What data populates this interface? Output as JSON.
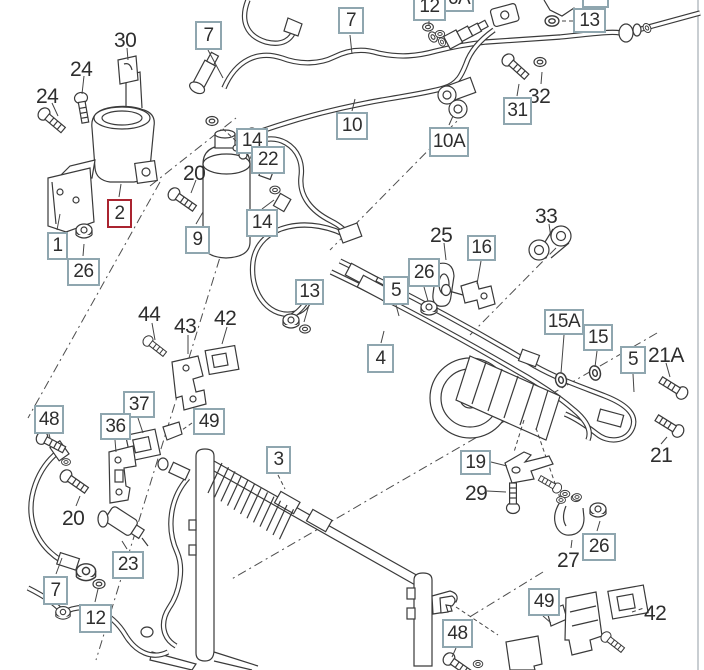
{
  "diagram": {
    "type": "exploded-parts-diagram",
    "subject": "air-conditioning-system",
    "highlighted_part": "2"
  },
  "colors": {
    "box_border": "#8fa6af",
    "highlight_border": "#aa2430",
    "line_art": "#3a3a3a",
    "text": "#2e2e2e",
    "background": "#ffffff"
  },
  "labels": {
    "boxed": [
      {
        "text": "7",
        "x": 195,
        "y": 21,
        "w": 27,
        "h": 29
      },
      {
        "text": "7",
        "x": 338,
        "y": 7,
        "w": 26,
        "h": 27
      },
      {
        "text": "12",
        "x": 413,
        "y": -7,
        "w": 33,
        "h": 28
      },
      {
        "text": "6A",
        "x": 444,
        "y": -15,
        "w": 30,
        "h": 27
      },
      {
        "text": "8",
        "x": 582,
        "y": -19,
        "w": 27,
        "h": 27
      },
      {
        "text": "13",
        "x": 573,
        "y": 8,
        "w": 33,
        "h": 25
      },
      {
        "text": "31",
        "x": 503,
        "y": 97,
        "w": 29,
        "h": 28
      },
      {
        "text": "10",
        "x": 336,
        "y": 112,
        "w": 32,
        "h": 28
      },
      {
        "text": "10A",
        "x": 429,
        "y": 127,
        "w": 40,
        "h": 30
      },
      {
        "text": "14",
        "x": 236,
        "y": 128,
        "w": 32,
        "h": 26
      },
      {
        "text": "22",
        "x": 251,
        "y": 146,
        "w": 34,
        "h": 28
      },
      {
        "text": "14",
        "x": 246,
        "y": 209,
        "w": 32,
        "h": 28
      },
      {
        "text": "9",
        "x": 185,
        "y": 226,
        "w": 25,
        "h": 28
      },
      {
        "text": "1",
        "x": 47,
        "y": 232,
        "w": 21,
        "h": 28
      },
      {
        "text": "26",
        "x": 67,
        "y": 258,
        "w": 33,
        "h": 28
      },
      {
        "text": "13",
        "x": 295,
        "y": 279,
        "w": 29,
        "h": 26
      },
      {
        "text": "5",
        "x": 383,
        "y": 276,
        "w": 26,
        "h": 29
      },
      {
        "text": "4",
        "x": 367,
        "y": 344,
        "w": 27,
        "h": 29
      },
      {
        "text": "26",
        "x": 408,
        "y": 258,
        "w": 32,
        "h": 29
      },
      {
        "text": "16",
        "x": 467,
        "y": 235,
        "w": 29,
        "h": 26
      },
      {
        "text": "15A",
        "x": 544,
        "y": 309,
        "w": 40,
        "h": 26
      },
      {
        "text": "15",
        "x": 583,
        "y": 324,
        "w": 30,
        "h": 27
      },
      {
        "text": "5",
        "x": 620,
        "y": 346,
        "w": 26,
        "h": 28
      },
      {
        "text": "19",
        "x": 460,
        "y": 450,
        "w": 31,
        "h": 25
      },
      {
        "text": "3",
        "x": 266,
        "y": 446,
        "w": 25,
        "h": 28
      },
      {
        "text": "48",
        "x": 34,
        "y": 405,
        "w": 30,
        "h": 29
      },
      {
        "text": "37",
        "x": 123,
        "y": 391,
        "w": 32,
        "h": 27
      },
      {
        "text": "36",
        "x": 100,
        "y": 413,
        "w": 31,
        "h": 27
      },
      {
        "text": "49",
        "x": 193,
        "y": 408,
        "w": 32,
        "h": 27
      },
      {
        "text": "23",
        "x": 112,
        "y": 551,
        "w": 32,
        "h": 28
      },
      {
        "text": "7",
        "x": 43,
        "y": 576,
        "w": 25,
        "h": 29
      },
      {
        "text": "12",
        "x": 79,
        "y": 604,
        "w": 33,
        "h": 29
      },
      {
        "text": "26",
        "x": 582,
        "y": 533,
        "w": 34,
        "h": 28
      },
      {
        "text": "49",
        "x": 528,
        "y": 588,
        "w": 32,
        "h": 28
      },
      {
        "text": "48",
        "x": 442,
        "y": 619,
        "w": 31,
        "h": 29
      }
    ],
    "highlighted": [
      {
        "text": "2",
        "x": 107,
        "y": 199,
        "w": 25,
        "h": 29
      }
    ],
    "plain": [
      {
        "text": "30",
        "x": 114,
        "y": 29
      },
      {
        "text": "24",
        "x": 70,
        "y": 58
      },
      {
        "text": "24",
        "x": 36,
        "y": 85
      },
      {
        "text": "20",
        "x": 183,
        "y": 162
      },
      {
        "text": "32",
        "x": 528,
        "y": 85
      },
      {
        "text": "25",
        "x": 430,
        "y": 224
      },
      {
        "text": "33",
        "x": 535,
        "y": 205
      },
      {
        "text": "21A",
        "x": 648,
        "y": 344
      },
      {
        "text": "21",
        "x": 650,
        "y": 444
      },
      {
        "text": "29",
        "x": 465,
        "y": 482
      },
      {
        "text": "27",
        "x": 557,
        "y": 549
      },
      {
        "text": "44",
        "x": 138,
        "y": 303
      },
      {
        "text": "43",
        "x": 174,
        "y": 315
      },
      {
        "text": "42",
        "x": 214,
        "y": 307
      },
      {
        "text": "20",
        "x": 62,
        "y": 507
      },
      {
        "text": "42",
        "x": 644,
        "y": 602
      }
    ]
  }
}
